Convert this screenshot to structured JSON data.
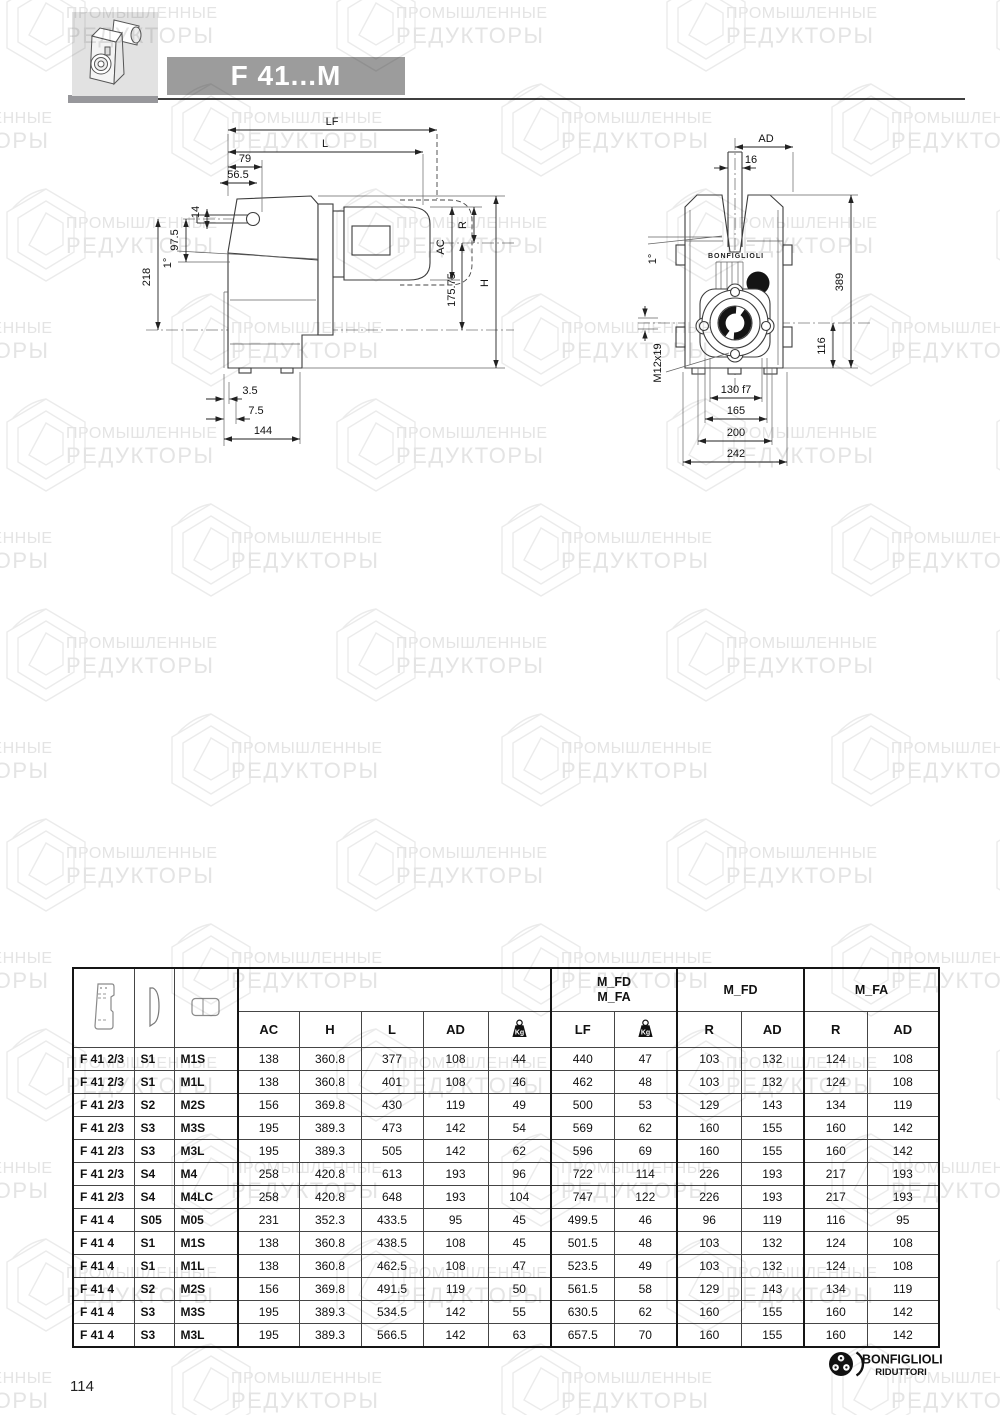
{
  "header": {
    "title": "F 41...M"
  },
  "watermark": {
    "line1": "ПРОМЫШЛЕННЫЕ",
    "line2": "РЕДУКТОРЫ"
  },
  "drawing_left": {
    "labels": {
      "lf": "LF",
      "l": "L",
      "d79": "79",
      "d565": "56.5",
      "d14": "14",
      "d975": "97.5",
      "d218": "218",
      "deg": "1°",
      "d35": "3.5",
      "d75": "7.5",
      "d144": "144",
      "r": "R",
      "ac": "AC",
      "d17575": "175.75",
      "h": "H"
    }
  },
  "drawing_right": {
    "brand": "BONFIGLIOLI",
    "labels": {
      "ad": "AD",
      "d16": "16",
      "deg": "1°",
      "m12": "M12x19",
      "d389": "389",
      "d116": "116",
      "d130": "130 f7",
      "d165": "165",
      "d200": "200",
      "d242": "242"
    }
  },
  "table": {
    "head": {
      "group_fd": "M_FD",
      "group_fa": "M_FA",
      "ac": "AC",
      "h": "H",
      "l": "L",
      "ad": "AD",
      "kg": "Kg",
      "lf": "LF",
      "r": "R"
    },
    "rows": [
      {
        "model": "F 41 2/3",
        "s": "S1",
        "m": "M1S",
        "ac": "138",
        "h": "360.8",
        "l": "377",
        "ad": "108",
        "kg": "44",
        "lf": "440",
        "kg2": "47",
        "r_fd": "103",
        "ad_fd": "132",
        "r_fa": "124",
        "ad_fa": "108"
      },
      {
        "model": "F 41 2/3",
        "s": "S1",
        "m": "M1L",
        "ac": "138",
        "h": "360.8",
        "l": "401",
        "ad": "108",
        "kg": "46",
        "lf": "462",
        "kg2": "48",
        "r_fd": "103",
        "ad_fd": "132",
        "r_fa": "124",
        "ad_fa": "108"
      },
      {
        "model": "F 41 2/3",
        "s": "S2",
        "m": "M2S",
        "ac": "156",
        "h": "369.8",
        "l": "430",
        "ad": "119",
        "kg": "49",
        "lf": "500",
        "kg2": "53",
        "r_fd": "129",
        "ad_fd": "143",
        "r_fa": "134",
        "ad_fa": "119"
      },
      {
        "model": "F 41 2/3",
        "s": "S3",
        "m": "M3S",
        "ac": "195",
        "h": "389.3",
        "l": "473",
        "ad": "142",
        "kg": "54",
        "lf": "569",
        "kg2": "62",
        "r_fd": "160",
        "ad_fd": "155",
        "r_fa": "160",
        "ad_fa": "142"
      },
      {
        "model": "F 41 2/3",
        "s": "S3",
        "m": "M3L",
        "ac": "195",
        "h": "389.3",
        "l": "505",
        "ad": "142",
        "kg": "62",
        "lf": "596",
        "kg2": "69",
        "r_fd": "160",
        "ad_fd": "155",
        "r_fa": "160",
        "ad_fa": "142"
      },
      {
        "model": "F 41 2/3",
        "s": "S4",
        "m": "M4",
        "ac": "258",
        "h": "420.8",
        "l": "613",
        "ad": "193",
        "kg": "96",
        "lf": "722",
        "kg2": "114",
        "r_fd": "226",
        "ad_fd": "193",
        "r_fa": "217",
        "ad_fa": "193"
      },
      {
        "model": "F 41 2/3",
        "s": "S4",
        "m": "M4LC",
        "ac": "258",
        "h": "420.8",
        "l": "648",
        "ad": "193",
        "kg": "104",
        "lf": "747",
        "kg2": "122",
        "r_fd": "226",
        "ad_fd": "193",
        "r_fa": "217",
        "ad_fa": "193"
      },
      {
        "model": "F 41 4",
        "s": "S05",
        "m": "M05",
        "ac": "231",
        "h": "352.3",
        "l": "433.5",
        "ad": "95",
        "kg": "45",
        "lf": "499.5",
        "kg2": "46",
        "r_fd": "96",
        "ad_fd": "119",
        "r_fa": "116",
        "ad_fa": "95"
      },
      {
        "model": "F 41 4",
        "s": "S1",
        "m": "M1S",
        "ac": "138",
        "h": "360.8",
        "l": "438.5",
        "ad": "108",
        "kg": "45",
        "lf": "501.5",
        "kg2": "48",
        "r_fd": "103",
        "ad_fd": "132",
        "r_fa": "124",
        "ad_fa": "108"
      },
      {
        "model": "F 41 4",
        "s": "S1",
        "m": "M1L",
        "ac": "138",
        "h": "360.8",
        "l": "462.5",
        "ad": "108",
        "kg": "47",
        "lf": "523.5",
        "kg2": "49",
        "r_fd": "103",
        "ad_fd": "132",
        "r_fa": "124",
        "ad_fa": "108"
      },
      {
        "model": "F 41 4",
        "s": "S2",
        "m": "M2S",
        "ac": "156",
        "h": "369.8",
        "l": "491.5",
        "ad": "119",
        "kg": "50",
        "lf": "561.5",
        "kg2": "58",
        "r_fd": "129",
        "ad_fd": "143",
        "r_fa": "134",
        "ad_fa": "119"
      },
      {
        "model": "F 41 4",
        "s": "S3",
        "m": "M3S",
        "ac": "195",
        "h": "389.3",
        "l": "534.5",
        "ad": "142",
        "kg": "55",
        "lf": "630.5",
        "kg2": "62",
        "r_fd": "160",
        "ad_fd": "155",
        "r_fa": "160",
        "ad_fa": "142"
      },
      {
        "model": "F 41 4",
        "s": "S3",
        "m": "M3L",
        "ac": "195",
        "h": "389.3",
        "l": "566.5",
        "ad": "142",
        "kg": "63",
        "lf": "657.5",
        "kg2": "70",
        "r_fd": "160",
        "ad_fd": "155",
        "r_fa": "160",
        "ad_fa": "142"
      }
    ]
  },
  "footer": {
    "page_number": "114",
    "brand": "BONFIGLIOLI",
    "brand_sub": "RIDUTTORI"
  }
}
